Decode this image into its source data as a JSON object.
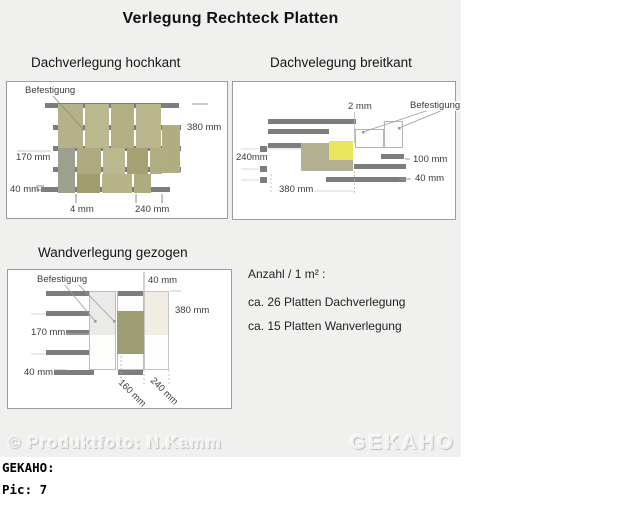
{
  "title": "Verlegung Rechteck Platten",
  "panels": {
    "hochkant": {
      "title": "Dachverlegung hochkant",
      "befestigung": "Befestigung",
      "dim_380": "380 mm",
      "dim_170": "170 mm",
      "dim_40": "40 mm",
      "dim_4": "4 mm",
      "dim_240": "240 mm"
    },
    "breitkant": {
      "title": "Dachvelegung breitkant",
      "befestigung": "Befestigung",
      "dim_2": "2 mm",
      "dim_240": "240mm",
      "dim_100": "100 mm",
      "dim_40": "40 mm",
      "dim_380": "380 mm"
    },
    "wand": {
      "title": "Wandverlegung gezogen",
      "befestigung": "Befestigung",
      "dim_40_top": "40 mm",
      "dim_380": "380 mm",
      "dim_170": "170 mm",
      "dim_40_bottom": "40 mm",
      "dim_160": "160 mm",
      "dim_240": "240 mm"
    }
  },
  "info": {
    "heading": "Anzahl / 1 m² :",
    "lines": [
      "ca. 26 Platten Dachverlegung",
      "ca. 15 Platten Wanverlegung"
    ]
  },
  "watermarks": {
    "copyright": "© Produktfoto: N.Kamm",
    "brand": "GEKAHO"
  },
  "caption": {
    "brand_line": "GEKAHO:",
    "pic_line": "Pic: 7"
  },
  "colors": {
    "canvas_bg": "#f0f0ee",
    "batten_gray": "#7d7d7d",
    "plate_khaki": "#b7b48a",
    "plate_khaki_light": "#bbb88e",
    "plate_khaki_dark": "#a09c6d",
    "plate_graygreen": "#9ba18e",
    "plate_olive": "#9d9d73",
    "plate_yellow": "#e9e55c",
    "plate_cream": "#f2ede3"
  }
}
